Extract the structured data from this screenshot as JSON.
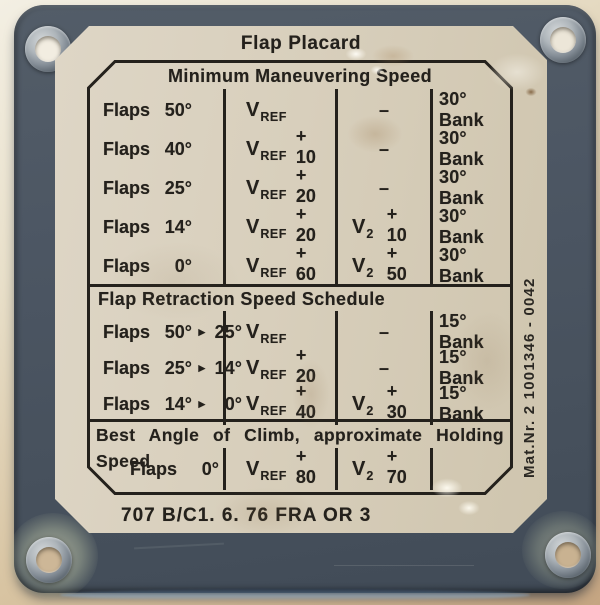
{
  "placard": {
    "title": "Flap Placard",
    "bottom_code": "707 B/C1. 6. 76 FRA OR 3",
    "side_text": "Mat.Nr. 2 1001346 - 0042",
    "colors": {
      "ink": "#24211c",
      "plate": "#4c5663",
      "face": "#d8cfbd"
    },
    "icons": {
      "arrow_right": "►"
    },
    "dash": "–",
    "sections": [
      {
        "header": "Minimum Maneuvering Speed",
        "header_align": "center",
        "rows": [
          {
            "flaps_label": "Flaps",
            "flaps_val": "50°",
            "vref": {
              "base": "V",
              "sub": "REF",
              "add": ""
            },
            "v2": {
              "dash": true
            },
            "bank": "30° Bank"
          },
          {
            "flaps_label": "Flaps",
            "flaps_val": "40°",
            "vref": {
              "base": "V",
              "sub": "REF",
              "add": "+ 10"
            },
            "v2": {
              "dash": true
            },
            "bank": "30° Bank"
          },
          {
            "flaps_label": "Flaps",
            "flaps_val": "25°",
            "vref": {
              "base": "V",
              "sub": "REF",
              "add": "+ 20"
            },
            "v2": {
              "dash": true
            },
            "bank": "30° Bank"
          },
          {
            "flaps_label": "Flaps",
            "flaps_val": "14°",
            "vref": {
              "base": "V",
              "sub": "REF",
              "add": "+ 20"
            },
            "v2": {
              "base": "V",
              "sub": "2",
              "add": "+ 10"
            },
            "bank": "30° Bank"
          },
          {
            "flaps_label": "Flaps",
            "flaps_val": "0°",
            "vref": {
              "base": "V",
              "sub": "REF",
              "add": "+ 60"
            },
            "v2": {
              "base": "V",
              "sub": "2",
              "add": "+ 50"
            },
            "bank": "30° Bank"
          }
        ]
      },
      {
        "header": "Flap Retraction Speed Schedule",
        "header_align": "left",
        "rows": [
          {
            "flaps_label": "Flaps",
            "flaps_val": "50°",
            "flaps_to": "25°",
            "vref": {
              "base": "V",
              "sub": "REF",
              "add": ""
            },
            "v2": {
              "dash": true
            },
            "bank": "15° Bank"
          },
          {
            "flaps_label": "Flaps",
            "flaps_val": "25°",
            "flaps_to": "14°",
            "vref": {
              "base": "V",
              "sub": "REF",
              "add": "+ 20"
            },
            "v2": {
              "dash": true
            },
            "bank": "15° Bank"
          },
          {
            "flaps_label": "Flaps",
            "flaps_val": "14°",
            "flaps_to": "0°",
            "vref": {
              "base": "V",
              "sub": "REF",
              "add": "+ 40"
            },
            "v2": {
              "base": "V",
              "sub": "2",
              "add": "+ 30"
            },
            "bank": "15° Bank"
          }
        ]
      },
      {
        "header": "Best Angle of Climb, approximate Holding Speed",
        "header_align": "justify",
        "rows": [
          {
            "flaps_label": "Flaps",
            "flaps_val": "0°",
            "indent": true,
            "vref": {
              "base": "V",
              "sub": "REF",
              "add": "+ 80"
            },
            "v2": {
              "base": "V",
              "sub": "2",
              "add": "+ 70"
            },
            "bank": ""
          }
        ]
      }
    ]
  }
}
